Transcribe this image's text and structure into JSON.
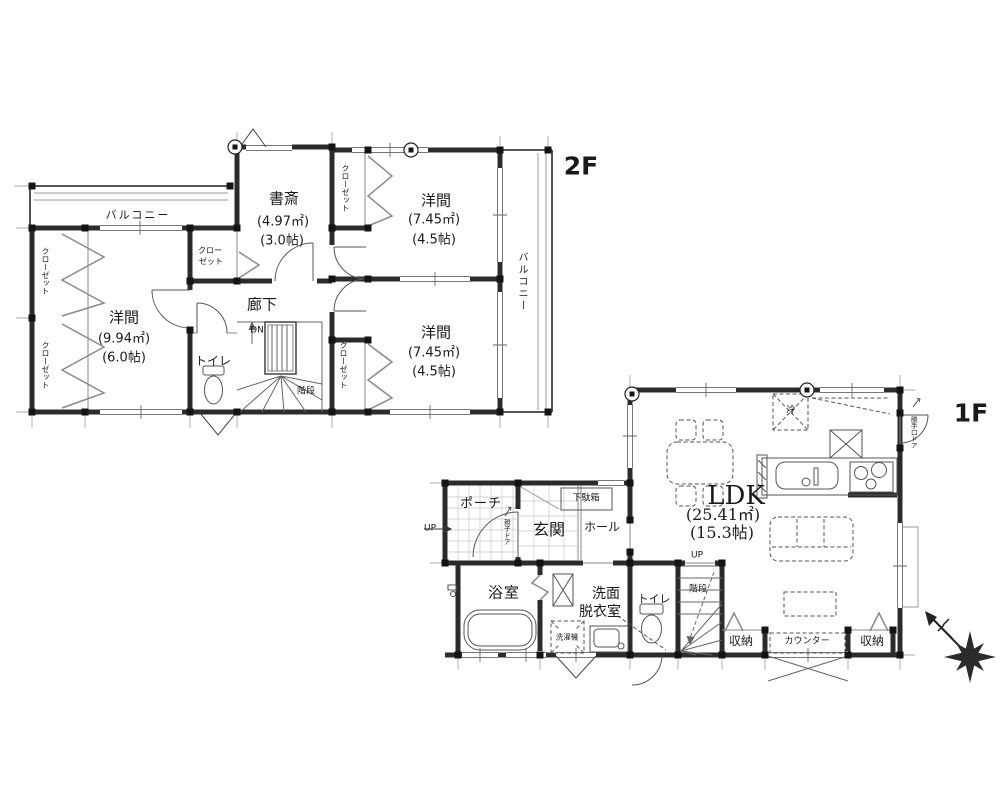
{
  "floor2": {
    "title": "2F",
    "balcony_top": "バルコニー",
    "balcony_right": "バルコニー",
    "closet": "クローゼット",
    "closet_split_top": "クロー",
    "closet_split_bottom": "ゼット",
    "room_sw": {
      "name": "洋間",
      "area": "(9.94㎡)",
      "size": "(6.0帖)"
    },
    "study": {
      "name": "書斎",
      "area": "(4.97㎡)",
      "size": "(3.0帖)"
    },
    "room_ne": {
      "name": "洋間",
      "area": "(7.45㎡)",
      "size": "(4.5帖)"
    },
    "room_se": {
      "name": "洋間",
      "area": "(7.45㎡)",
      "size": "(4.5帖)"
    },
    "corridor": "廊下",
    "dn": "DN",
    "toilet": "トイレ",
    "stairs": "階段"
  },
  "floor1": {
    "title": "1F",
    "ldk": {
      "name": "LDK",
      "area": "(25.41㎡)",
      "size": "(15.3帖)"
    },
    "porch": "ポーチ",
    "porch_up": "UP",
    "entrance": "玄関",
    "entrance_door": "親子ドア",
    "shoe_cabinet": "下駄箱",
    "hall": "ホール",
    "bathroom": "浴室",
    "washroom_line1": "洗面",
    "washroom_line2": "脱衣室",
    "washing_machine": "洗濯機",
    "toilet": "トイレ",
    "stairs": "階段",
    "stairs_up": "UP",
    "fridge": "冷",
    "back_door": "勝手口ドア",
    "storage_left": "収納",
    "storage_right": "収納",
    "counter": "カウンター"
  }
}
